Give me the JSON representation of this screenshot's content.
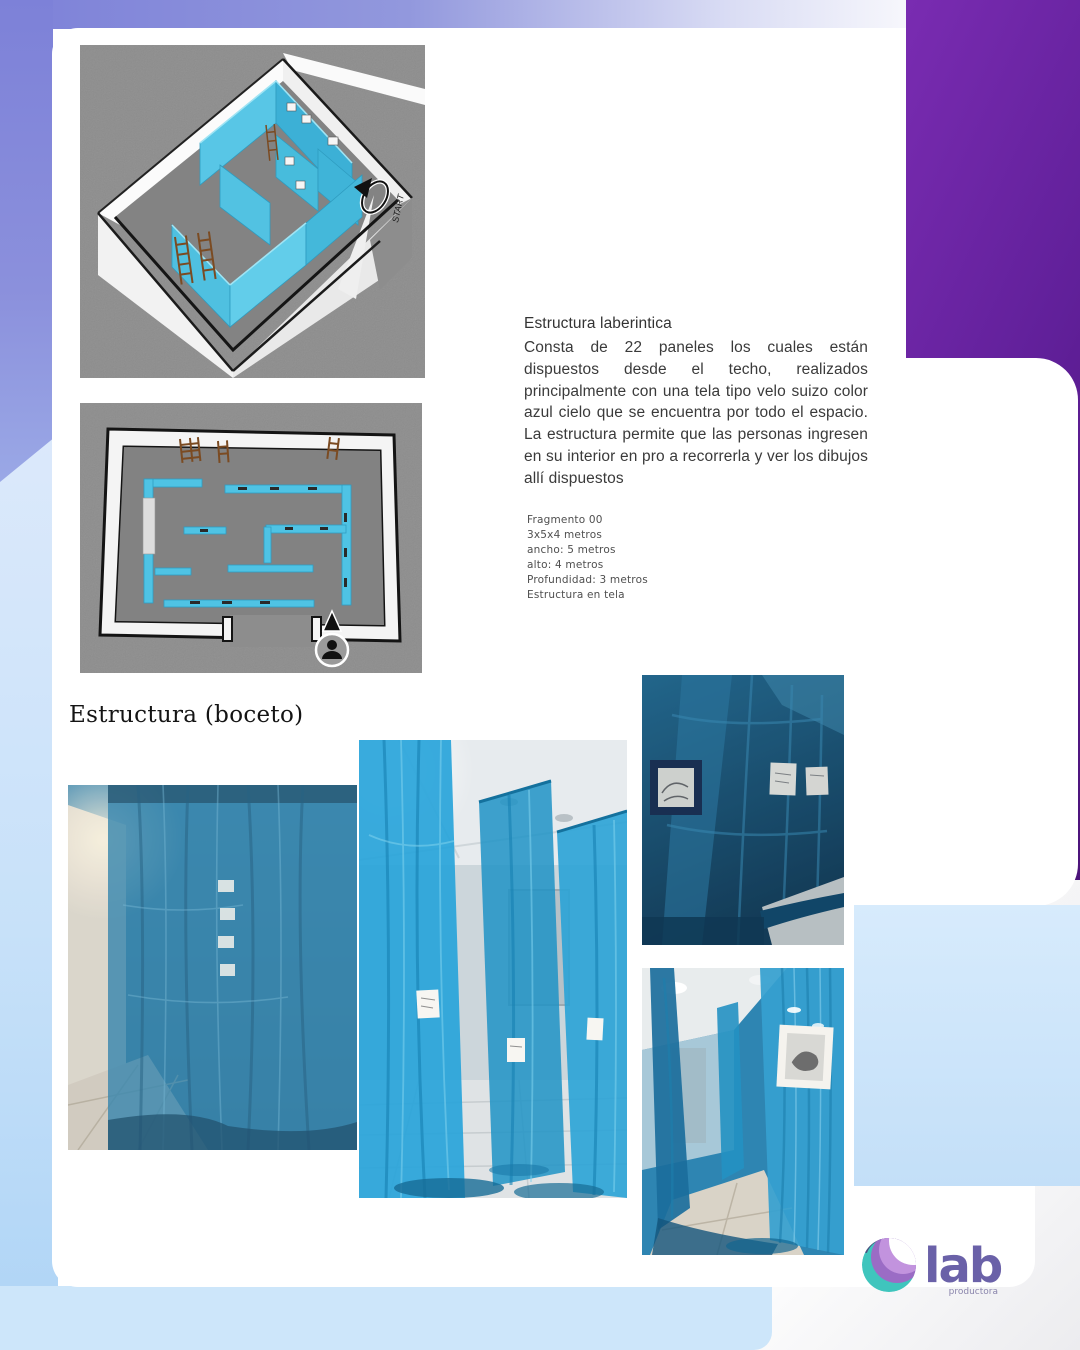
{
  "section": {
    "title": "Estructura laberintica",
    "description": "Consta de 22 paneles los cuales están dispuestos desde el techo, realizados principalmente con una tela tipo velo suizo color azul cielo que se encuentra por todo el espacio. La estructura permite que las personas ingresen en su interior en pro a recorrerla y ver los dibujos allí dispuestos",
    "specs": {
      "lines": [
        "Fragmento 00",
        "3x5x4 metros",
        "ancho: 5 metros",
        "alto: 4 metros",
        "Profundidad: 3 metros",
        "Estructura en tela"
      ]
    },
    "sketch_heading": "Estructura (boceto)"
  },
  "renders": {
    "start_label": "START"
  },
  "logo": {
    "name": "lab",
    "tagline": "productora"
  },
  "colors": {
    "accent_purple": "#5c1b92",
    "periwinkle": "#7d81d8",
    "light_blue": "#cde6fa",
    "maze_blue": "#4fc3e4",
    "logo_purple": "#6a61a8",
    "logo_teal": "#3fc5bd",
    "logo_lavender": "#c293de"
  }
}
